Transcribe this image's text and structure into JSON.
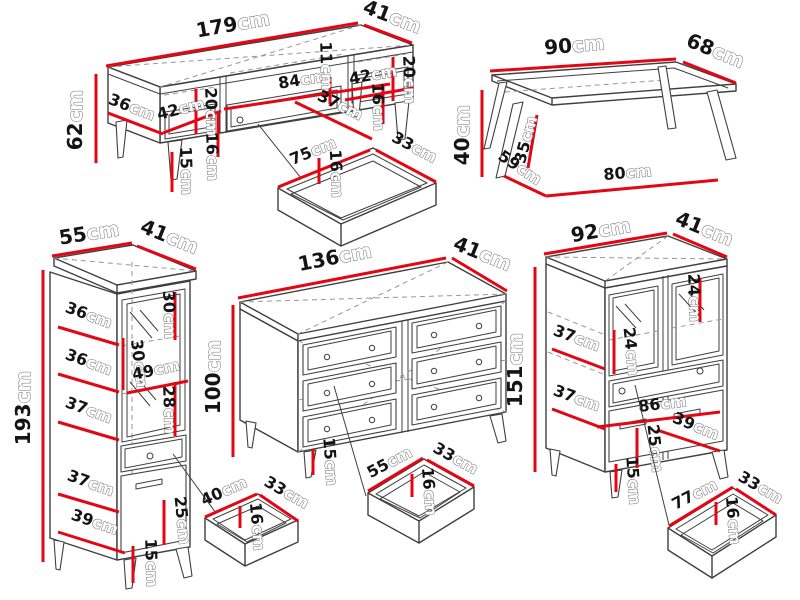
{
  "diagram": {
    "unit": "cm",
    "dimension_color": "#e30613",
    "outline_color": "#3f3f3f",
    "background": "#ffffff"
  },
  "tv_stand": {
    "width": "179",
    "top_depth": "41",
    "height": "62",
    "base_depth": "36",
    "left_compartment_width": "42",
    "left_compartment_height": "20",
    "left_drawer_height": "16",
    "leg_height": "15",
    "niche_width": "84",
    "niche_top_height": "11",
    "niche_depth": "37",
    "right_compartment_width": "42",
    "right_compartment_height": "20",
    "right_drawer_height": "16",
    "drawer": {
      "width": "75",
      "depth": "33",
      "height": "16"
    }
  },
  "coffee_table": {
    "top_width": "90",
    "top_depth": "68",
    "height": "40",
    "base_depth": "59",
    "leg_height": "35",
    "base_width": "80"
  },
  "tall_cabinet": {
    "top_width": "55",
    "top_depth": "41",
    "height": "193",
    "shelf_width_1": "36",
    "shelf_width_2": "36",
    "shelf_width_3": "37",
    "shelf_width_4": "37",
    "base_width": "39",
    "top_compartment_height": "30",
    "middle_compartment_height": "30",
    "inner_width": "49",
    "lower_compartment_height": "28",
    "door_height": "25",
    "leg_height": "15",
    "drawer": {
      "width": "40",
      "depth": "33",
      "height": "16"
    }
  },
  "dresser": {
    "width": "136",
    "top_depth": "41",
    "height": "100",
    "leg_height": "15",
    "drawer": {
      "width": "55",
      "depth": "33",
      "height": "16"
    }
  },
  "highboard": {
    "width": "92",
    "top_depth": "41",
    "height": "151",
    "right_glass_height": "24",
    "left_glass_height": "24",
    "shelf_width_1": "37",
    "shelf_width_2": "37",
    "inner_width": "86",
    "door_height": "25",
    "base_depth": "39",
    "leg_height": "15",
    "drawer": {
      "width": "77",
      "depth": "33",
      "height": "16"
    }
  }
}
